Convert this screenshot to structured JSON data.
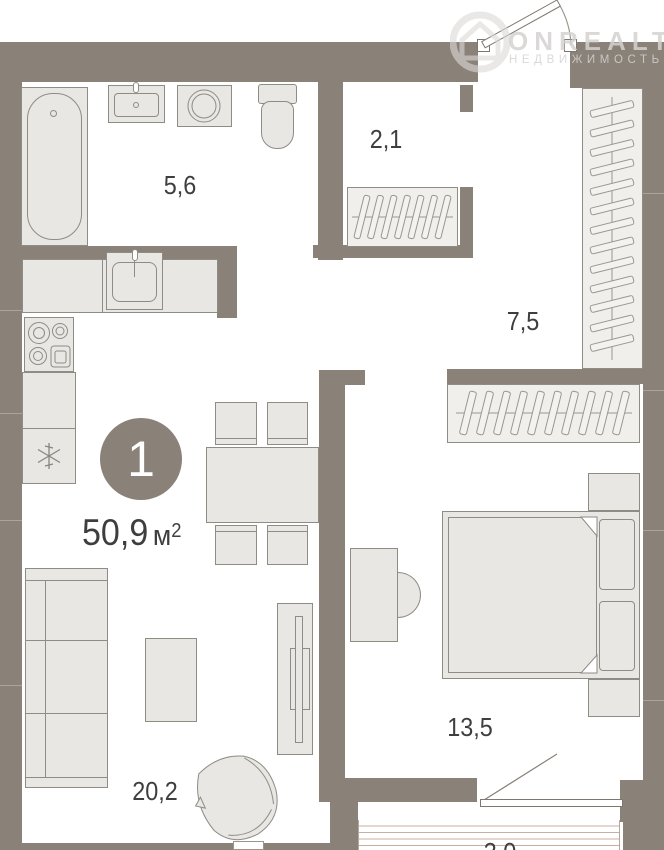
{
  "floorplan": {
    "room_count": "1",
    "total_area": {
      "value": "50,9",
      "unit": "м",
      "sup": "2"
    },
    "rooms": {
      "bathroom": "5,6",
      "wardrobe": "2,1",
      "hallway": "7,5",
      "bedroom": "13,5",
      "living_kitchen": "20,2",
      "balcony": "3,0"
    }
  },
  "watermark": {
    "brand": "ONREALT",
    "tagline": "НЕДВИЖИМОСТЬ"
  },
  "colors": {
    "wall": "#8a8178",
    "furn": "#e9e7e3",
    "ink": "#3e3e3e",
    "stripe": "#c8afa3",
    "wm": "#d5d3d1"
  }
}
